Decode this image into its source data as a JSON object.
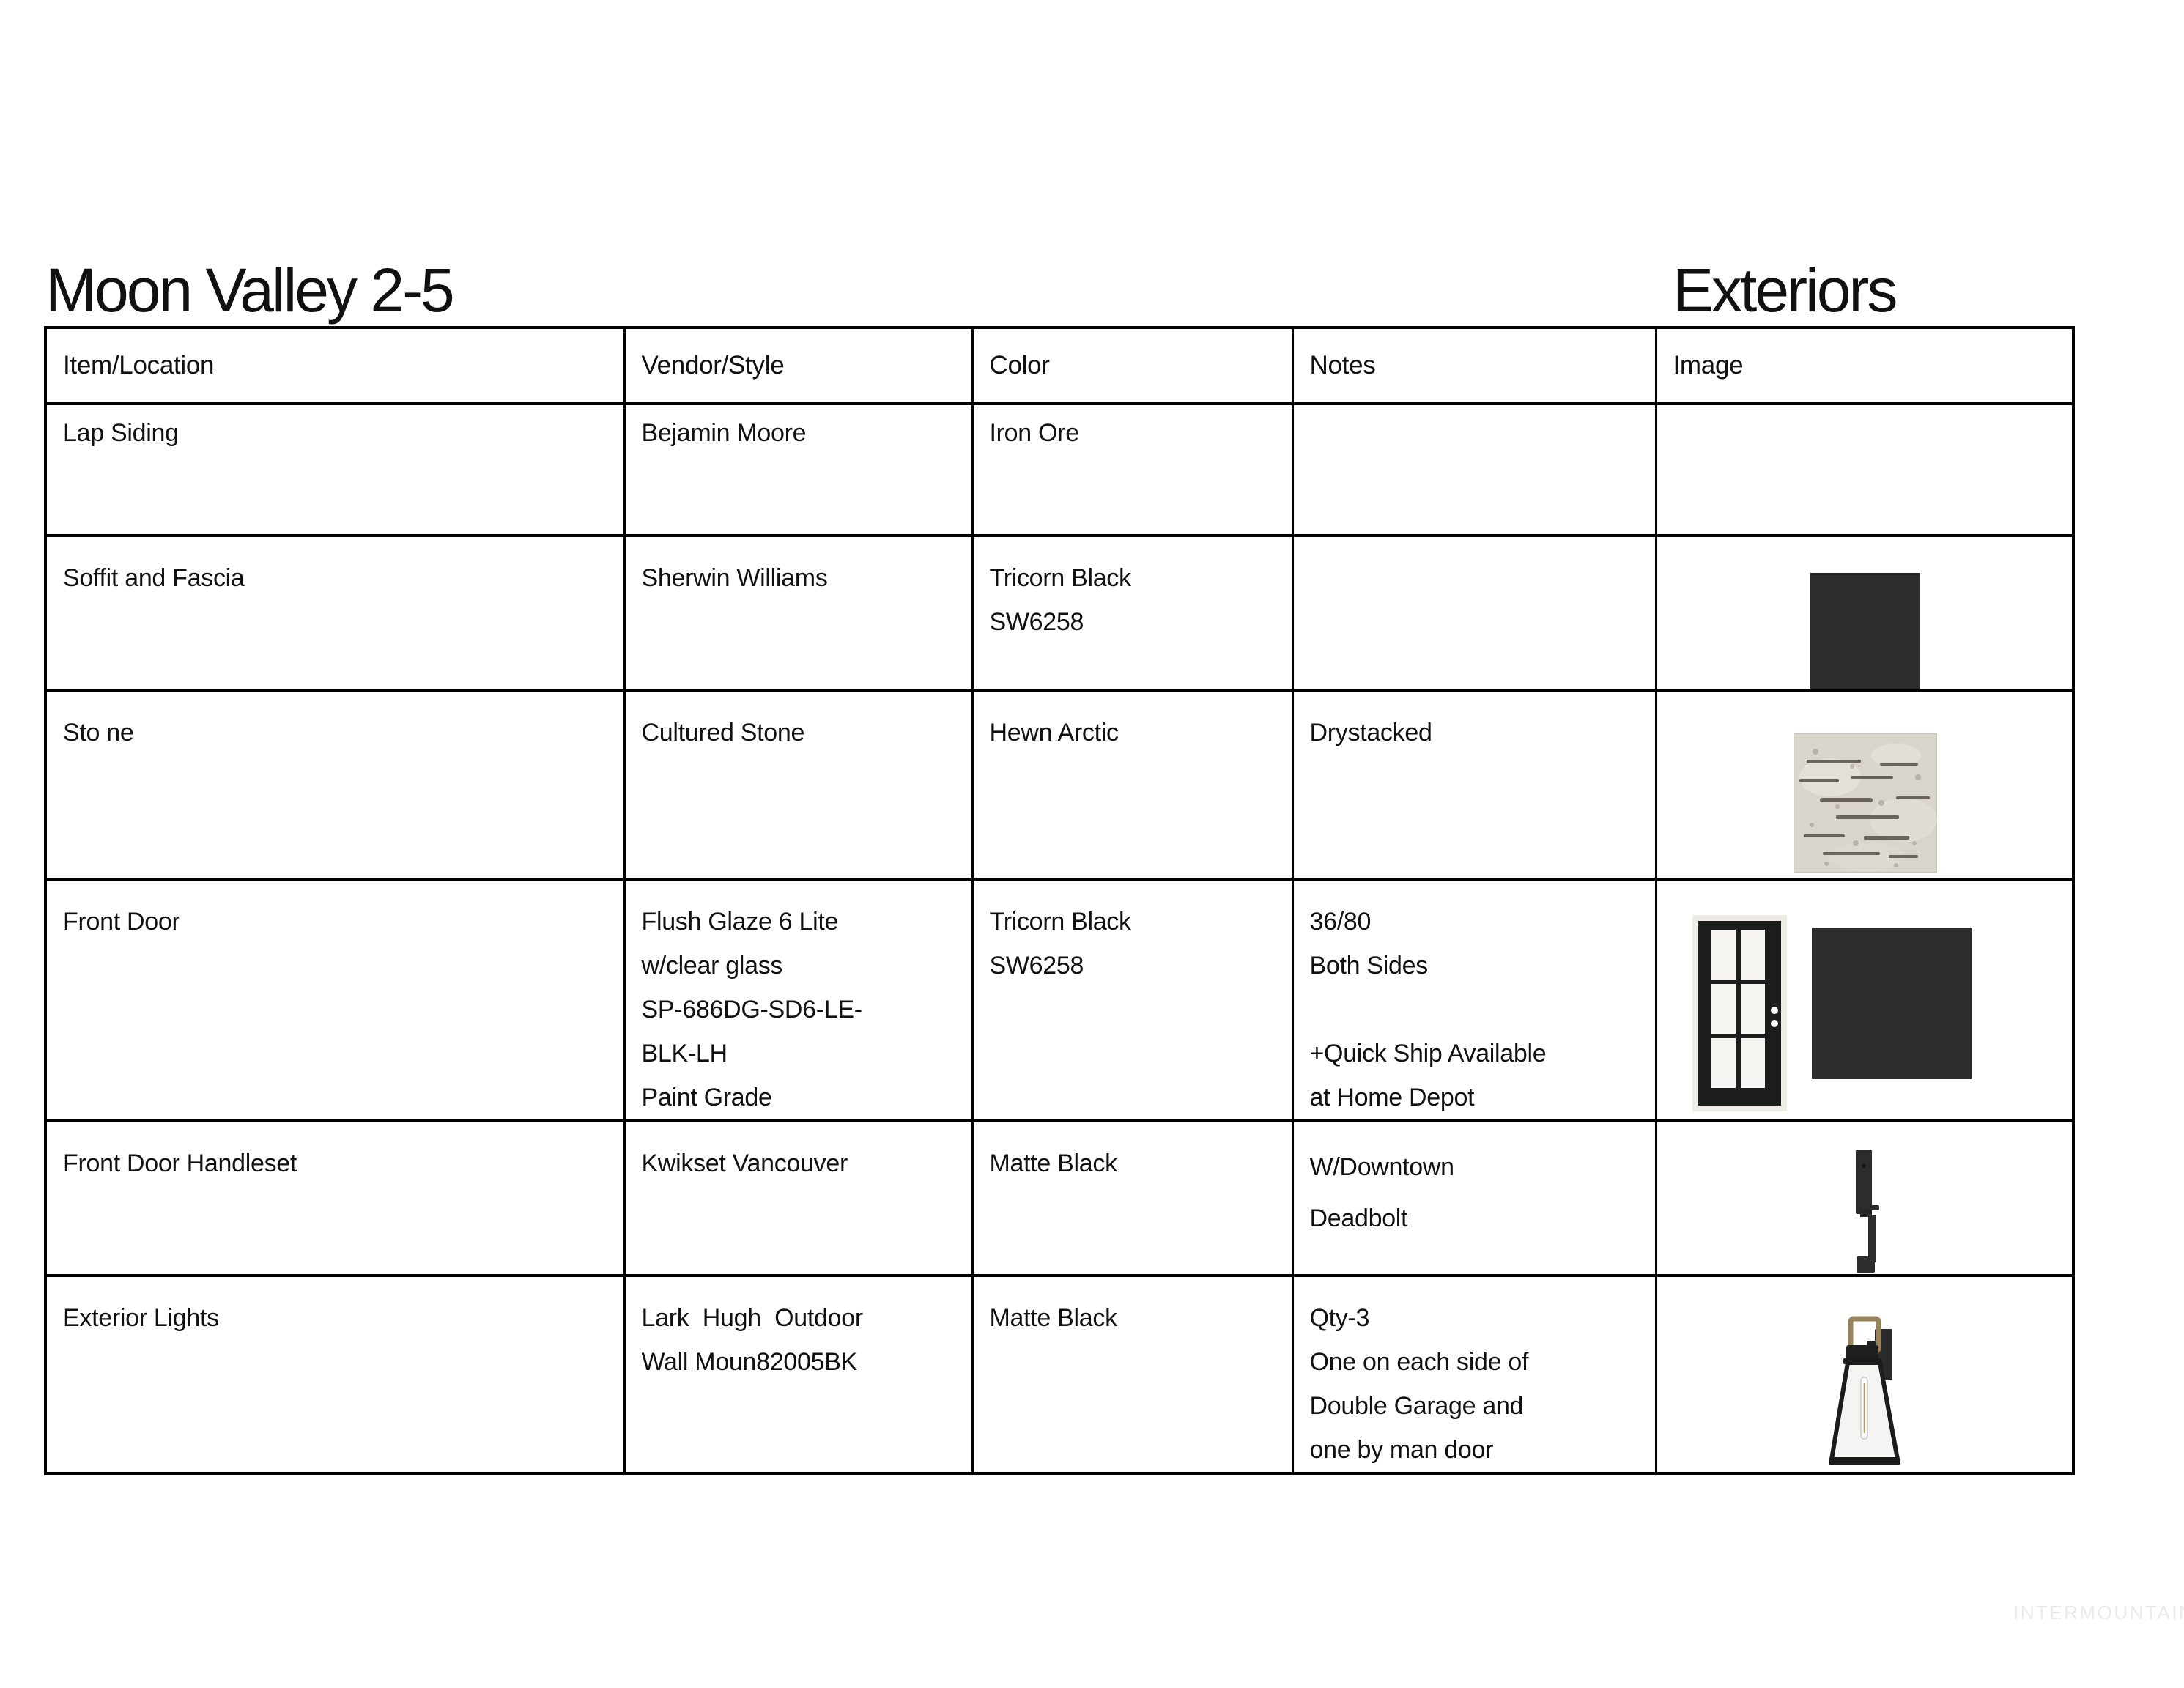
{
  "page": {
    "title": "Moon Valley 2-5",
    "subtitle": "Exteriors",
    "watermark": "INTERMOUNTAIN"
  },
  "table": {
    "columns": [
      "Item/Location",
      "Vendor/Style",
      "Color",
      "Notes",
      "Image"
    ],
    "rows": [
      {
        "item": "Lap Siding",
        "vendor": "Bejamin Moore",
        "color": "Iron Ore",
        "notes": "",
        "image": ""
      },
      {
        "item": "Soffit and Fascia",
        "vendor": "Sherwin Williams",
        "color": "Tricorn Black\nSW6258",
        "notes": "",
        "image": "tricorn-black-paint-swatch"
      },
      {
        "item": "Sto ne",
        "vendor": "Cultured Stone",
        "color": "Hewn Arctic",
        "notes": "Drystacked",
        "image": "hewn-arctic-stone-sample"
      },
      {
        "item": "Front Door",
        "vendor": "Flush Glaze 6 Lite\nw/clear glass\nSP-686DG-SD6-LE-\nBLK-LH\nPaint Grade",
        "color": "Tricorn Black\nSW6258",
        "notes": "36/80\nBoth Sides\n\n+Quick Ship Available\nat Home Depot",
        "image": "six-lite-black-door-and-tricorn-black-swatch"
      },
      {
        "item": "Front Door Handleset",
        "vendor": "Kwikset Vancouver",
        "color": "Matte Black",
        "notes": "W/Downtown\nDeadbolt",
        "image": "matte-black-handleset-photo"
      },
      {
        "item": "Exterior Lights",
        "vendor": "Lark  Hugh  Outdoor\nWall Moun82005BK",
        "color": "Matte Black",
        "notes": "Qty-3\nOne on each side of\nDouble Garage and\none by man door",
        "image": "outdoor-wall-lantern-photo"
      }
    ]
  },
  "colors": {
    "text": "#111111",
    "table_border": "#000000",
    "charcoal_swatch": "#2d2d2d",
    "door_frame": "#efece6",
    "door_slab": "#1d1d1d",
    "door_glass": "#f6f5f2",
    "stone_base": "#d9d5cc",
    "stone_streak": "#57504a",
    "lantern_frame": "#1c1c1c",
    "lantern_brass": "#97835a",
    "lantern_glass": "#f4f4f3",
    "watermark_gray": "#ebebeb"
  }
}
